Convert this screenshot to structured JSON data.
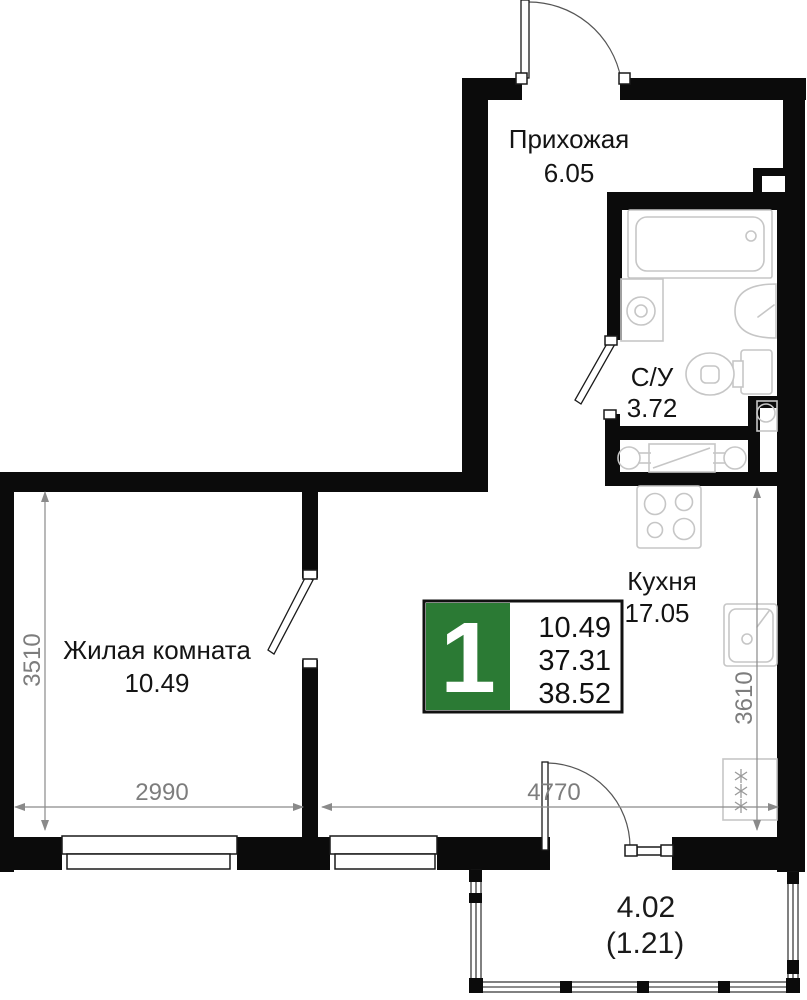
{
  "badge": {
    "rooms": "1",
    "area_living": "10.49",
    "area_main": "37.31",
    "area_total": "38.52",
    "color": "#2b7a34"
  },
  "rooms": {
    "hallway": {
      "name": "Прихожая",
      "area": "6.05"
    },
    "bathroom": {
      "name": "С/У",
      "area": "3.72"
    },
    "living_room": {
      "name": "Жилая комната",
      "area": "10.49"
    },
    "kitchen": {
      "name": "Кухня",
      "area": "17.05"
    },
    "balcony": {
      "area": "4.02",
      "area_coef": "(1.21)"
    }
  },
  "dimensions": {
    "living_width": "2990",
    "living_depth": "3510",
    "kitchen_width": "4770",
    "kitchen_depth": "3610"
  }
}
